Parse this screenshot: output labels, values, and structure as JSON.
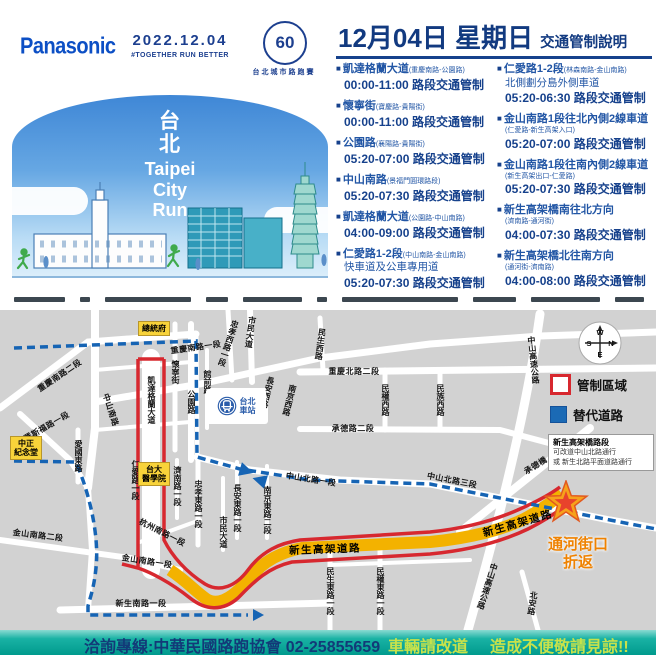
{
  "header": {
    "brand": "Panasonic",
    "date": "2022.12.04",
    "slogan": "#TOGETHER RUN BETTER",
    "anniversary": "60",
    "event_name": "台北城市路跑賽"
  },
  "banner": {
    "title_zh_1": "台",
    "title_zh_2": "北",
    "line1": "Taipei",
    "line2": "City",
    "line3": "Run"
  },
  "notice": {
    "title_date": "12月04日 星期日",
    "title_suffix": "交通管制說明",
    "left_items": [
      {
        "name": "凱達格蘭大道",
        "detail": "(重慶南路-公園路)",
        "time": "00:00-11:00 路段交通管制"
      },
      {
        "name": "懷寧街",
        "detail": "(寶慶路-貴陽街)",
        "time": "00:00-11:00 路段交通管制"
      },
      {
        "name": "公園路",
        "detail": "(襄陽路-貴陽街)",
        "time": "05:20-07:00 路段交通管制"
      },
      {
        "name": "中山南路",
        "detail": "(景福門圓環路段)",
        "time": "05:20-07:30 路段交通管制"
      },
      {
        "name": "凱達格蘭大道",
        "detail": "(公園路-中山南路)",
        "time": "04:00-09:00 路段交通管制"
      },
      {
        "name": "仁愛路1-2段",
        "detail": "(中山南路-金山南路)",
        "sub": "快車道及公車專用道",
        "time": "05:20-07:30 路段交通管制"
      }
    ],
    "right_items": [
      {
        "name": "仁愛路1-2段",
        "detail": "(林森南路-金山南路)",
        "sub": "北側劃分島外側車道",
        "time": "05:20-06:30 路段交通管制"
      },
      {
        "name": "金山南路1段往北內側2線車道",
        "detail": "(仁愛路-新生高架入口)",
        "time": "05:20-07:00 路段交通管制"
      },
      {
        "name": "金山南路1段往南內側2線車道",
        "detail": "(新生高架出口-仁愛路)",
        "time": "05:20-07:30 路段交通管制"
      },
      {
        "name": "新生高架橋南往北方向",
        "detail": "(濟南路-通河街)",
        "time": "04:00-07:30 路段交通管制"
      },
      {
        "name": "新生高架橋北往南方向",
        "detail": "(通河街-濟南路)",
        "time": "04:00-08:00 路段交通管制"
      }
    ]
  },
  "map": {
    "compass": {
      "n": "N",
      "s": "S",
      "e": "E",
      "w": "W"
    },
    "legend_restricted": "管制區域",
    "legend_alternate": "替代道路",
    "note_title": "新生高架橋路段",
    "note_line1": "可改道中山北路通行",
    "note_line2": "或 新生北路平面道路通行",
    "turnaround_line1": "通河街口",
    "turnaround_line2": "折返",
    "station_line1": "台北",
    "station_line2": "車站",
    "landmarks": [
      {
        "lines": [
          "總統府"
        ],
        "x": 138,
        "y": 11
      },
      {
        "lines": [
          "中正",
          "紀念堂"
        ],
        "x": 10,
        "y": 126
      },
      {
        "lines": [
          "台大",
          "醫學院"
        ],
        "x": 138,
        "y": 152
      }
    ],
    "street_labels": [
      {
        "t": "重慶南路一段",
        "x": 196,
        "y": 38,
        "r": -8
      },
      {
        "t": "重慶南路二段",
        "x": 60,
        "y": 66,
        "r": -34
      },
      {
        "t": "羅斯福路一段",
        "x": 47,
        "y": 117,
        "r": -30
      },
      {
        "t": "中山南路",
        "x": 110,
        "y": 100,
        "r": 72
      },
      {
        "t": "凱達格蘭大道",
        "x": 151,
        "y": 90,
        "v": 1
      },
      {
        "t": "懷寧街",
        "x": 175,
        "y": 62,
        "v": 1
      },
      {
        "t": "公園路",
        "x": 191,
        "y": 92,
        "v": 1
      },
      {
        "t": "館前路",
        "x": 207,
        "y": 72,
        "v": 1
      },
      {
        "t": "忠孝西路一段",
        "x": 228,
        "y": 33,
        "v": 1,
        "r": 18
      },
      {
        "t": "市民大道",
        "x": 250,
        "y": 22,
        "v": 1,
        "r": 8
      },
      {
        "t": "長安西路",
        "x": 267,
        "y": 82,
        "v": 1,
        "r": 14
      },
      {
        "t": "南京西路",
        "x": 289,
        "y": 90,
        "v": 1,
        "r": 14
      },
      {
        "t": "民生西路",
        "x": 320,
        "y": 34,
        "v": 1,
        "r": 8
      },
      {
        "t": "重慶北路二段",
        "x": 354,
        "y": 62
      },
      {
        "t": "民權西路",
        "x": 385,
        "y": 90,
        "v": 1
      },
      {
        "t": "民族西路",
        "x": 440,
        "y": 90,
        "v": 1
      },
      {
        "t": "中山高速公路",
        "x": 533,
        "y": 50,
        "v": 1,
        "r": -6
      },
      {
        "t": "承德路二段",
        "x": 353,
        "y": 119
      },
      {
        "t": "承德橋",
        "x": 536,
        "y": 156,
        "r": -32
      },
      {
        "t": "中山北路一段",
        "x": 311,
        "y": 170,
        "r": 9
      },
      {
        "t": "中山北路三段",
        "x": 452,
        "y": 171,
        "r": 11
      },
      {
        "t": "仁愛路一段",
        "x": 135,
        "y": 170,
        "v": 1
      },
      {
        "t": "濟南路一段",
        "x": 177,
        "y": 176,
        "v": 1
      },
      {
        "t": "忠孝東路一段",
        "x": 198,
        "y": 194,
        "v": 1
      },
      {
        "t": "杭州南路一段",
        "x": 162,
        "y": 223,
        "r": 27
      },
      {
        "t": "長安東路一段",
        "x": 237,
        "y": 198,
        "v": 1
      },
      {
        "t": "市民大道",
        "x": 223,
        "y": 222,
        "v": 1
      },
      {
        "t": "南京東路二段",
        "x": 267,
        "y": 200,
        "v": 1
      },
      {
        "t": "金山南路二段",
        "x": 38,
        "y": 226,
        "r": 7
      },
      {
        "t": "金山南路一段",
        "x": 147,
        "y": 252,
        "r": 9
      },
      {
        "t": "新生南路一段",
        "x": 141,
        "y": 294
      },
      {
        "t": "新生高架道路",
        "x": 325,
        "y": 240,
        "cls": "hw",
        "r": -2
      },
      {
        "t": "新生高架道路",
        "x": 518,
        "y": 214,
        "cls": "hw",
        "r": -16
      },
      {
        "t": "民生東路一段",
        "x": 330,
        "y": 281,
        "v": 1
      },
      {
        "t": "民權東路一段",
        "x": 380,
        "y": 281,
        "v": 1
      },
      {
        "t": "中山高速公路",
        "x": 487,
        "y": 276,
        "v": 1,
        "r": 18
      },
      {
        "t": "北安路",
        "x": 532,
        "y": 293,
        "v": 1,
        "r": 8
      },
      {
        "t": "愛國東路",
        "x": 78,
        "y": 146,
        "v": 1
      }
    ]
  },
  "footer": {
    "hotline": "洽詢專線:中華民國路跑協會 02-25855659",
    "advice1": "車輛請改道",
    "advice2": "造成不便敬請見諒!!"
  },
  "colors": {
    "navy": "#16418c",
    "panasonic_blue": "#0c4fc5",
    "restricted_red": "#d7282f",
    "route_yellow": "#f3b200",
    "alternate_blue": "#1664b4",
    "footer_teal": "#009a8d",
    "landmark_yellow": "#f8d33a",
    "turnaround_orange": "#ef8200"
  }
}
